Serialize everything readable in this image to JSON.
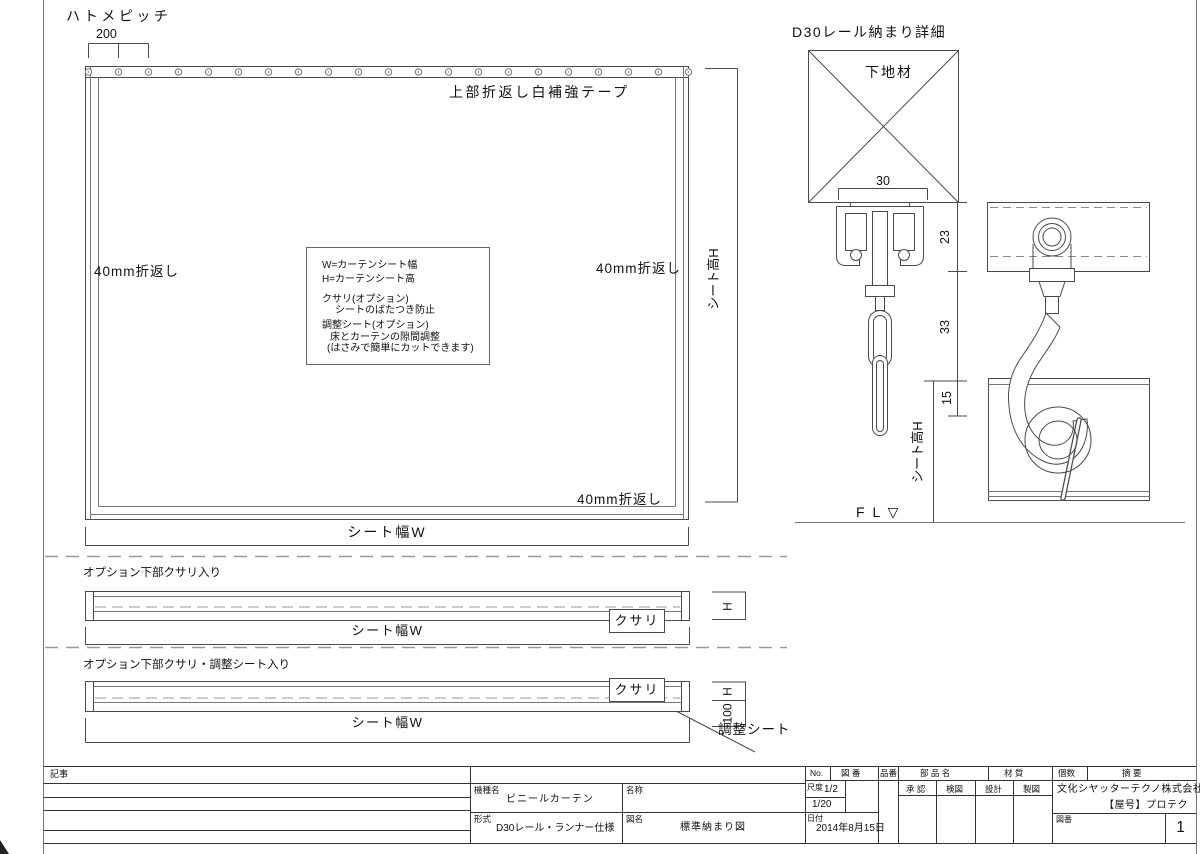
{
  "main_view": {
    "hatome_pitch": "ハトメピッチ",
    "pitch_value": "200",
    "top_tape": "上部折返し白補強テープ",
    "fold_left": "40mm折返し",
    "fold_right": "40mm折返し",
    "fold_bottom": "40mm折返し",
    "width_label": "シート幅W",
    "height_label": "シート高H",
    "notes": [
      "W=カーテンシート幅",
      "H=カーテンシート高",
      "クサリ(オプション)",
      "シートのばたつき防止",
      "調整シート(オプション)",
      "床とカーテンの隙間調整",
      "(はさみで簡単にカットできます)"
    ]
  },
  "detail_view": {
    "title": "D30レール納まり詳細",
    "base_material": "下地材",
    "dim_30": "30",
    "dim_23": "23",
    "dim_33": "33",
    "dim_15": "15",
    "sheet_height_label": "シート高H",
    "floor_line": "F L ▽"
  },
  "option1": {
    "title": "オプション下部クサリ入り",
    "chain_label": "クサリ",
    "width_label": "シート幅W",
    "height_label": "H"
  },
  "option2": {
    "title": "オプション下部クサリ・調整シート入り",
    "chain_label": "クサリ",
    "width_label": "シート幅W",
    "height_label": "H",
    "dim_100": "100",
    "adjust_sheet_label": "調整シート"
  },
  "title_block": {
    "remarks_label": "記事",
    "model": {
      "label": "機種名",
      "value": "ビニールカーテン"
    },
    "name": {
      "label": "名称",
      "value": ""
    },
    "type": {
      "label": "形式",
      "value": "D30レール・ランナー仕様"
    },
    "drawing_name": {
      "label": "図名",
      "value": "標準納まり図"
    },
    "headers": {
      "no": "No.",
      "zuban": "図 番",
      "hinban": "品番",
      "buhinmei": "部 品 名",
      "zaishitsu": "材 質",
      "kosu": "個数",
      "tekiyo": "摘 要"
    },
    "scale": {
      "label": "尺度",
      "value1": "1/2",
      "value2": "1/20"
    },
    "date": {
      "label": "日付",
      "value": "2014年8月15日"
    },
    "approvals": [
      "承 認",
      "検図",
      "設計",
      "製図"
    ],
    "company": {
      "name": "文化シヤッターテクノ株式会社",
      "brand": "【屋号】プロテク"
    },
    "sheet_no": {
      "label": "図番",
      "value": "1"
    }
  },
  "colors": {
    "line": "#4a4a4a",
    "text": "#111111",
    "dash": "#999999"
  }
}
